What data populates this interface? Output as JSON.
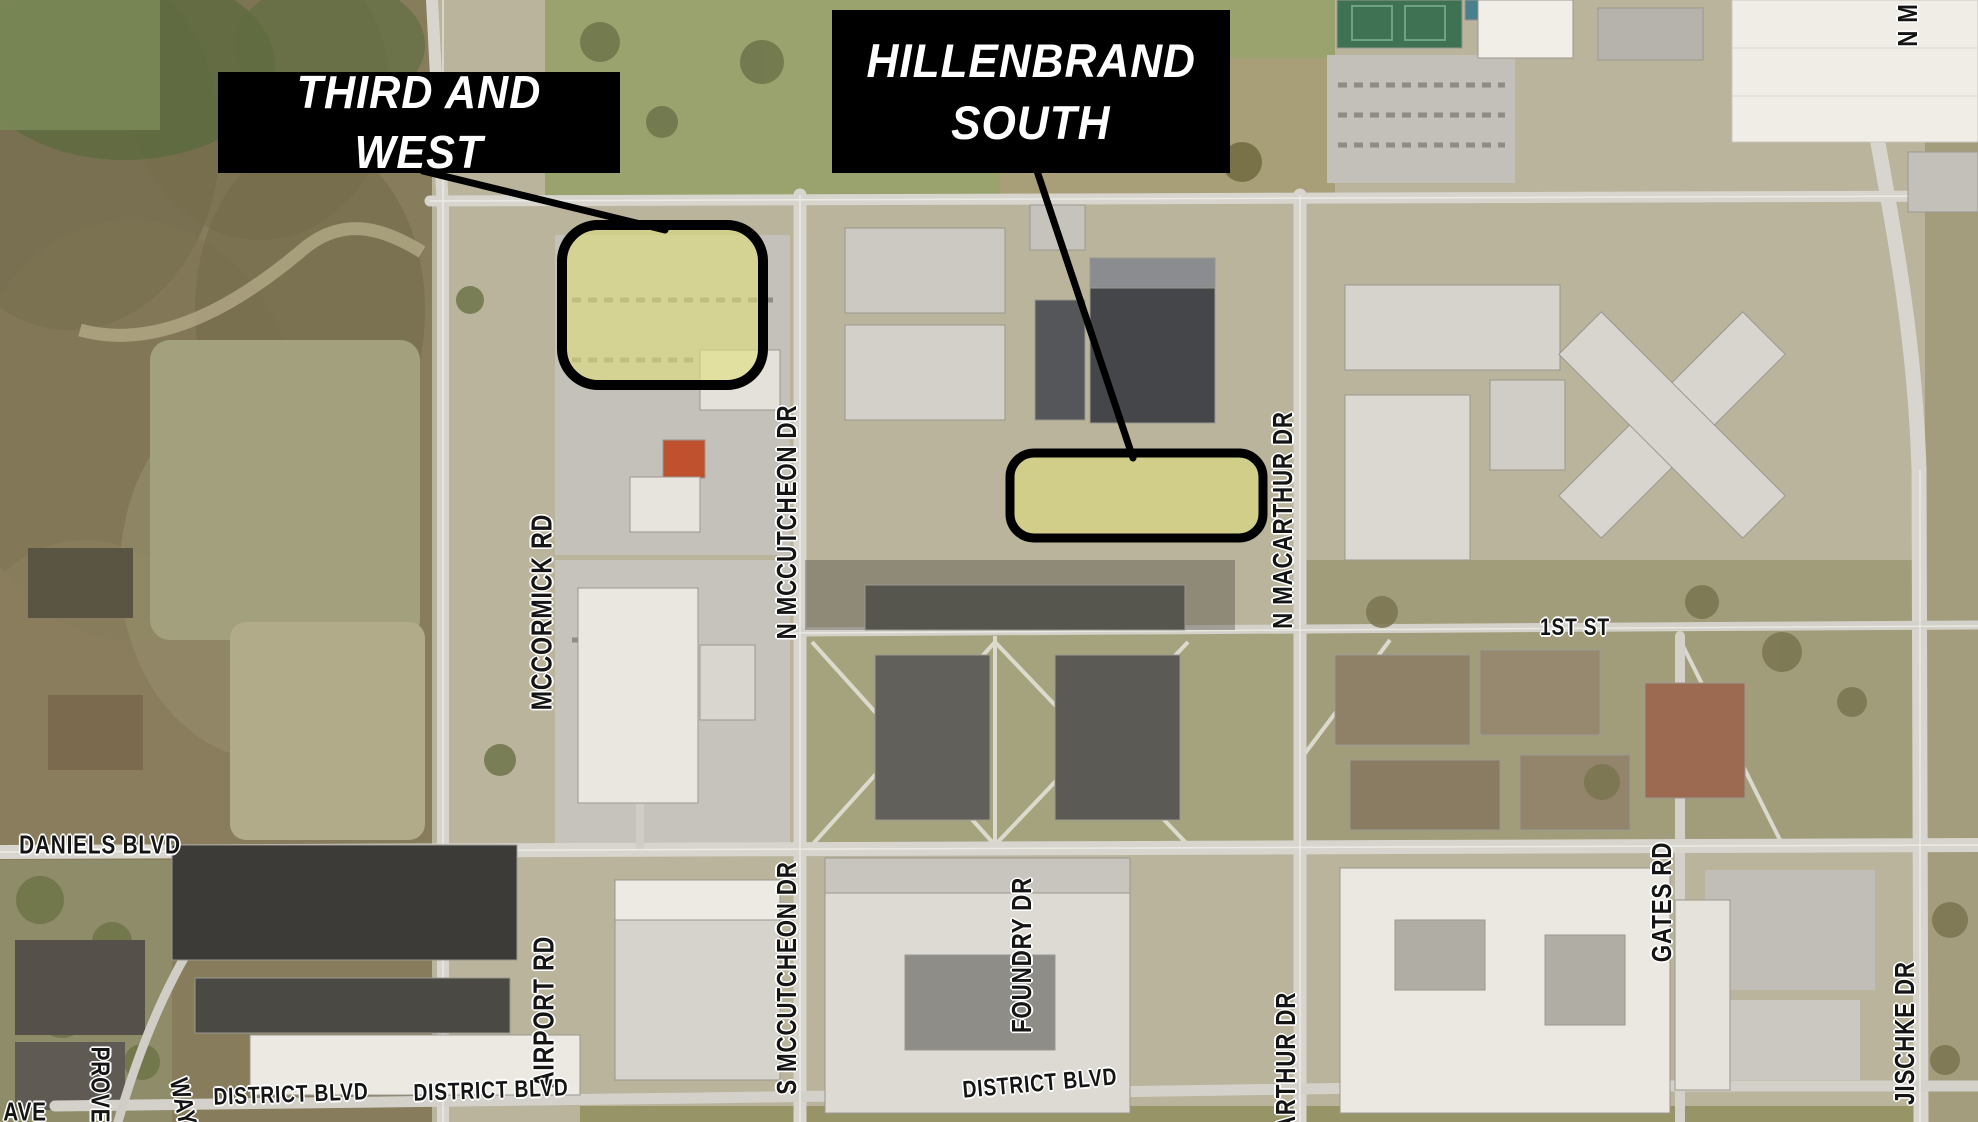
{
  "callouts": [
    {
      "id": "third-and-west",
      "lines": [
        "THIRD AND WEST"
      ]
    },
    {
      "id": "hillenbrand-south",
      "lines": [
        "HILLENBRAND",
        "SOUTH"
      ]
    }
  ],
  "zones": [
    {
      "id": "third-and-west",
      "label": "THIRD AND WEST"
    },
    {
      "id": "hillenbrand-south",
      "label": "HILLENBRAND SOUTH"
    }
  ],
  "street_labels": [
    {
      "text": "MCCORMICK RD",
      "x": 543,
      "y": 612,
      "rot": -90,
      "size": 29
    },
    {
      "text": "AIRPORT RD",
      "x": 545,
      "y": 1012,
      "rot": -90,
      "size": 29
    },
    {
      "text": "N MCCUTCHEON DR",
      "x": 787,
      "y": 522,
      "rot": -90,
      "size": 28
    },
    {
      "text": "S MCCUTCHEON DR",
      "x": 787,
      "y": 978,
      "rot": -90,
      "size": 28
    },
    {
      "text": "FOUNDRY DR",
      "x": 1022,
      "y": 955,
      "rot": -90,
      "size": 28
    },
    {
      "text": "N MACARTHUR DR",
      "x": 1283,
      "y": 520,
      "rot": -90,
      "size": 28
    },
    {
      "text": "ARTHUR DR",
      "x": 1286,
      "y": 1062,
      "rot": -90,
      "size": 28
    },
    {
      "text": "GATES RD",
      "x": 1662,
      "y": 902,
      "rot": -90,
      "size": 28
    },
    {
      "text": "JISCHKE DR",
      "x": 1905,
      "y": 1033,
      "rot": -90,
      "size": 28
    },
    {
      "text": "N M",
      "x": 1908,
      "y": 25,
      "rot": -90,
      "size": 28
    },
    {
      "text": "1ST ST",
      "x": 1575,
      "y": 628,
      "rot": 0,
      "size": 24
    },
    {
      "text": "DANIELS BLVD",
      "x": 100,
      "y": 845,
      "rot": 0,
      "size": 26
    },
    {
      "text": "DISTRICT BLVD",
      "x": 291,
      "y": 1095,
      "rot": -2,
      "size": 24
    },
    {
      "text": "DISTRICT BLVD",
      "x": 491,
      "y": 1091,
      "rot": -2,
      "size": 24
    },
    {
      "text": "DISTRICT BLVD",
      "x": 1040,
      "y": 1084,
      "rot": -5,
      "size": 24
    },
    {
      "text": "PROVE",
      "x": 100,
      "y": 1085,
      "rot": 90,
      "size": 26
    },
    {
      "text": "WAY",
      "x": 183,
      "y": 1102,
      "rot": 78,
      "size": 26
    },
    {
      "text": "AVE",
      "x": 25,
      "y": 1112,
      "rot": 0,
      "size": 26
    }
  ],
  "colors": {
    "highlight_fill": "#e0e07c",
    "highlight_stroke": "#000000",
    "callout_bg": "#000000",
    "callout_text": "#ffffff",
    "street_label_text": "#141414",
    "street_label_halo": "#ffffff"
  }
}
